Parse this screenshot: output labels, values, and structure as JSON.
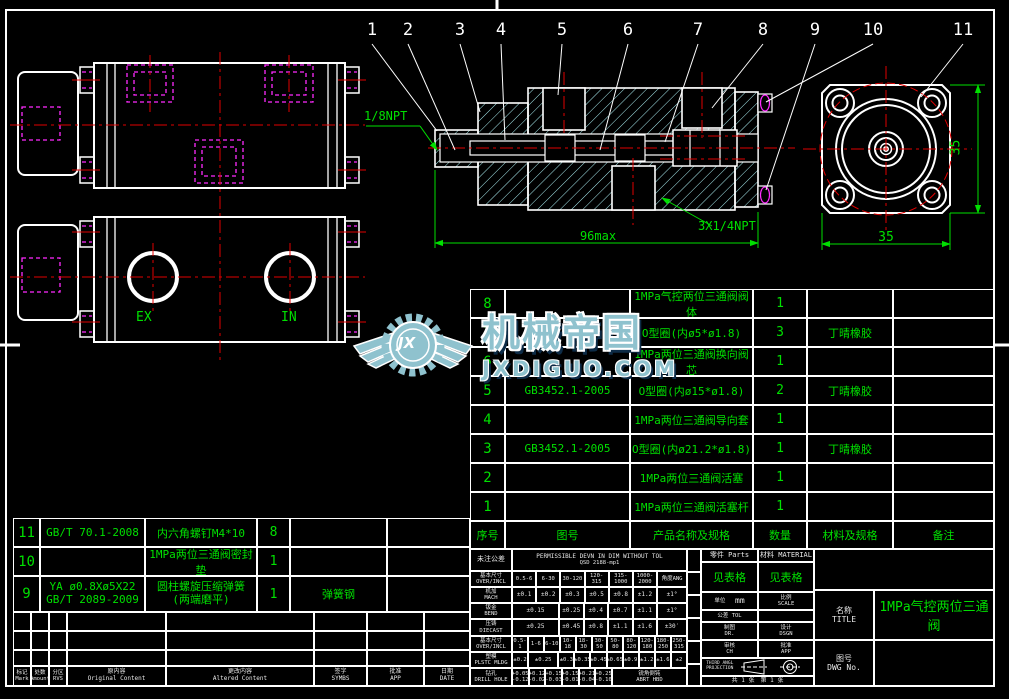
{
  "accents": {
    "line_white": "#ffffff",
    "cad_green": "#00e000",
    "centerline_red": "#e00000",
    "hidden_magenta": "#ff2bff",
    "hatch_cyan": "#a9ecf0",
    "watermark_teal": "#8fc2ce"
  },
  "callouts": [
    "1",
    "2",
    "3",
    "4",
    "5",
    "6",
    "7",
    "8",
    "9",
    "10",
    "11"
  ],
  "labels": {
    "npt18": "1/8NPT",
    "npt14": "3X1/4NPT",
    "dim96": "96max",
    "dim35b": "35",
    "dim35r": "35",
    "ex": "EX",
    "in": "IN"
  },
  "watermark": {
    "brand": "机械帝国",
    "domain": "JXDIGUO.COM",
    "monogram": "JX"
  },
  "bom": {
    "headers": [
      "序号",
      "图号",
      "产品名称及规格",
      "数量",
      "材料及规格",
      "备注"
    ],
    "rows": [
      {
        "seq": "8",
        "code": "",
        "name": "1MPa气控两位三通阀阀体",
        "qty": "1",
        "mat": "",
        "note": ""
      },
      {
        "seq": "7",
        "code": "",
        "name": "O型圈(内ø5*ø1.8)",
        "qty": "3",
        "mat": "丁晴橡胶",
        "note": ""
      },
      {
        "seq": "6",
        "code": "",
        "name": "1MPa两位三通阀换向阀芯",
        "qty": "1",
        "mat": "",
        "note": ""
      },
      {
        "seq": "5",
        "code": "GB3452.1-2005",
        "name": "O型圈(内ø15*ø1.8)",
        "qty": "2",
        "mat": "丁晴橡胶",
        "note": ""
      },
      {
        "seq": "4",
        "code": "",
        "name": "1MPa两位三通阀导向套",
        "qty": "1",
        "mat": "",
        "note": ""
      },
      {
        "seq": "3",
        "code": "GB3452.1-2005",
        "name": "O型圈(内ø21.2*ø1.8)",
        "qty": "1",
        "mat": "丁晴橡胶",
        "note": ""
      },
      {
        "seq": "2",
        "code": "",
        "name": "1MPa两位三通阀活塞",
        "qty": "1",
        "mat": "",
        "note": ""
      },
      {
        "seq": "1",
        "code": "",
        "name": "1MPa两位三通阀活塞杆",
        "qty": "1",
        "mat": "",
        "note": ""
      }
    ]
  },
  "bom_left": {
    "rows": [
      {
        "seq": "11",
        "code": "GB/T 70.1-2008",
        "name": "内六角螺钉M4*10",
        "qty": "8",
        "mat": "",
        "note": ""
      },
      {
        "seq": "10",
        "code": "",
        "name": "1MPa两位三通阀密封垫",
        "qty": "1",
        "mat": "",
        "note": ""
      },
      {
        "seq": "9",
        "code": "YA ø0.8Xø5X22\nGB/T 2089-2009",
        "name": "圆柱螺旋压缩弹簧\n(两端磨平)",
        "qty": "1",
        "mat": "弹簧钢",
        "note": ""
      }
    ]
  },
  "rev": {
    "h": [
      {
        "zh": "标记",
        "en": "Mark"
      },
      {
        "zh": "处数",
        "en": "Amount"
      },
      {
        "zh": "分区",
        "en": "RVS"
      },
      {
        "zh": "原内容",
        "en": "Original Content"
      },
      {
        "zh": "更改内容",
        "en": "Altered Content"
      },
      {
        "zh": "签字",
        "en": "SYMBS"
      },
      {
        "zh": "批准",
        "en": "APP"
      },
      {
        "zh": "日期",
        "en": "DATE"
      }
    ]
  },
  "tol": {
    "zh": "未注公差",
    "en": "PERMISSIBLE DEVN IN DIM WITHOUT TOL",
    "std": "QSD 2188-mp1",
    "dim_zh": "基本尺寸",
    "dim_en": "OVER/INCL",
    "ang_h": "角度ANG",
    "cols1": [
      "0.5-6",
      "6-30",
      "30-120",
      "120-315",
      "315-1000",
      "1000-2000"
    ],
    "mach_zh": "机加",
    "mach_en": "MACH",
    "mach": [
      "±0.1",
      "±0.2",
      "±0.3",
      "±0.5",
      "±0.8",
      "±1.2"
    ],
    "mach_ang": "±1°",
    "bend_zh": "钣金",
    "bend_en": "BEND",
    "bend": [
      "±0.15",
      "±0.25",
      "±0.4",
      "±0.7",
      "±1.1"
    ],
    "bend_ang": "±1°",
    "cast_zh": "压铸",
    "cast_en": "DIECAST",
    "cast": [
      "±0.25",
      "±0.45",
      "±0.8",
      "±1.1",
      "±1.6"
    ],
    "cast_ang": "±30′",
    "cols2": [
      "0.5-1",
      "1-6",
      "6-10",
      "10-18",
      "18-30",
      "30-50",
      "50-80",
      "80-120",
      "120-180",
      "180-250",
      "250-315"
    ],
    "plstc_zh": "塑模",
    "plstc_en": "PLSTC MLDG",
    "plstc": [
      "±0.2",
      "±0.25",
      "±0.3",
      "±0.35",
      "±0.45",
      "±0.65",
      "±0.9",
      "±1.2",
      "±1.6",
      "±2"
    ],
    "drill_zh": "钻孔",
    "drill_en": "DRILL HOLE",
    "drill": [
      "+0.05\n-0.12",
      "+0.12\n-0.02",
      "+0.15\n-0.03",
      "+0.15\n-0.01",
      "+0.21\n-0.04",
      "+0.25\n-0.10"
    ],
    "drill_note": "锐角倒钝\nABRT HBD"
  },
  "titleblock": {
    "parts_zh": "零件",
    "parts_en": "Parts",
    "material_zh": "材料",
    "material_en": "MATERIAL",
    "see_table_parts": "见表格",
    "see_table_material": "见表格",
    "unit_zh": "单位",
    "unit_en": "UNIT",
    "unit_value": "mm",
    "scale_zh": "比例",
    "scale_en": "SCALE",
    "tol_zh": "公差",
    "tol_en": "TOL",
    "dr_zh": "制图",
    "dr_en": "DR.",
    "dsgn_zh": "设计",
    "dsgn_en": "DSGN",
    "ch_zh": "审核",
    "ch_en": "CH",
    "app_zh": "批准",
    "app_en": "APP",
    "projection": "THIRD ANGL PROJECTION",
    "sheet": "共 1 张　第 1 张",
    "title_zh": "名称",
    "title_en": "TITLE",
    "title_value": "1MPa气控两位三通阀",
    "dwg_zh": "图号",
    "dwg_en": "DWG No.",
    "dwg_value": ""
  }
}
